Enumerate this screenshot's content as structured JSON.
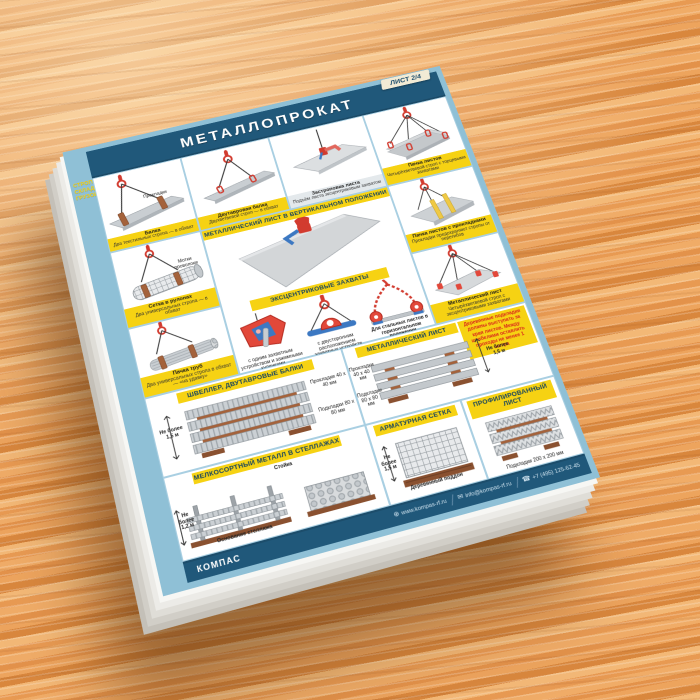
{
  "poster": {
    "badge": "ЛИСТ 2/4",
    "title": "МЕТАЛЛОПРОКАТ",
    "series": {
      "line1": "СТРОПОВКА И",
      "line2": "СКЛАДИРОВАНИЕ",
      "line3": "ГРУЗОВ"
    },
    "panels": [
      {
        "title": "Балка",
        "sub": "Два текстильных стропа — в обхват",
        "note": "Прокладки"
      },
      {
        "title": "Двутавровая балка",
        "sub": "Двухветвевой строп — в обхват"
      },
      {
        "title": "Застроповка листа",
        "sub": "Подъём листа эксцентриковым захватом"
      },
      {
        "title": "Пачка листов",
        "sub": "Четырёхветвевой строп с торцевыми захватами"
      },
      {
        "title": "Сетка в рулонах",
        "sub": "Два универсальных стропа — в обхват",
        "note": "Мотки проволоки"
      },
      {
        "title": "Пачка труб",
        "sub": "Два универсальных стропа в обхват — «на удавку»"
      },
      {
        "title": "Пачка листов с прокладками",
        "sub": "Прокладки предохраняют стропы от перегибов"
      },
      {
        "title": "Металлический лист",
        "sub": "Четырёхветвевой строп с эксцентриковыми захватами"
      }
    ],
    "center": {
      "banner_vertical": "МЕТАЛЛИЧЕСКИЙ ЛИСТ В ВЕРТИКАЛЬНОМ ПОЛОЖЕНИИ",
      "banner_grips": "ЭКСЦЕНТРИКОВЫЕ ЗАХВАТЫ",
      "grip1_caption": "с одним захватным устройством и зажимными кулачками",
      "grip2_caption": "с двусторонним расположением захватных устройств",
      "chain_caption": "Для стальных листов в горизонтальном положении"
    },
    "storage": {
      "channel": {
        "banner": "ШВЕЛЛЕР, ДВУТАВРОВЫЕ БАЛКИ",
        "spacers": "Прокладки 40 х 40 мм",
        "pads": "Подкладки 80 х 80 мм",
        "height": "Не более 1,5 м"
      },
      "small": {
        "banner": "МЕЛКОСОРТНЫЙ МЕТАЛЛ В СТЕЛЛАЖАХ",
        "post": "Стойка",
        "base": "Основание стеллажа",
        "height": "Не более 1,2 м"
      },
      "sheet": {
        "banner": "МЕТАЛЛИЧЕСКИЙ ЛИСТ",
        "spacers": "Прокладки 40 х 40 мм",
        "pads": "Подкладки 80 х 80 мм",
        "height": "Не более 1,5 м",
        "warning": "Деревянные подкладки должны выступать за края листов. Между штабелями оставлять проходы не менее 1 метра"
      },
      "mesh": {
        "banner": "АРМАТУРНАЯ СЕТКА",
        "height": "Не более 1,5 м",
        "pallet": "Деревянный поддон"
      },
      "profiled": {
        "banner": "ПРОФИЛИРОВАННЫЙ ЛИСТ",
        "pads": "Подкладки 200 х 200 мм"
      }
    },
    "footer": {
      "brand": "КОМПАС",
      "site": "www.kompas-rf.ru",
      "email": "info@kompas-rf.ru",
      "phone": "+7 (495) 125-62-45"
    }
  },
  "colors": {
    "header_blue": "#20587A",
    "frame_blue": "#8FC0D6",
    "banner_yellow": "#F6D213",
    "accent_red": "#D9251C",
    "wood_orange": "#E3924A"
  }
}
